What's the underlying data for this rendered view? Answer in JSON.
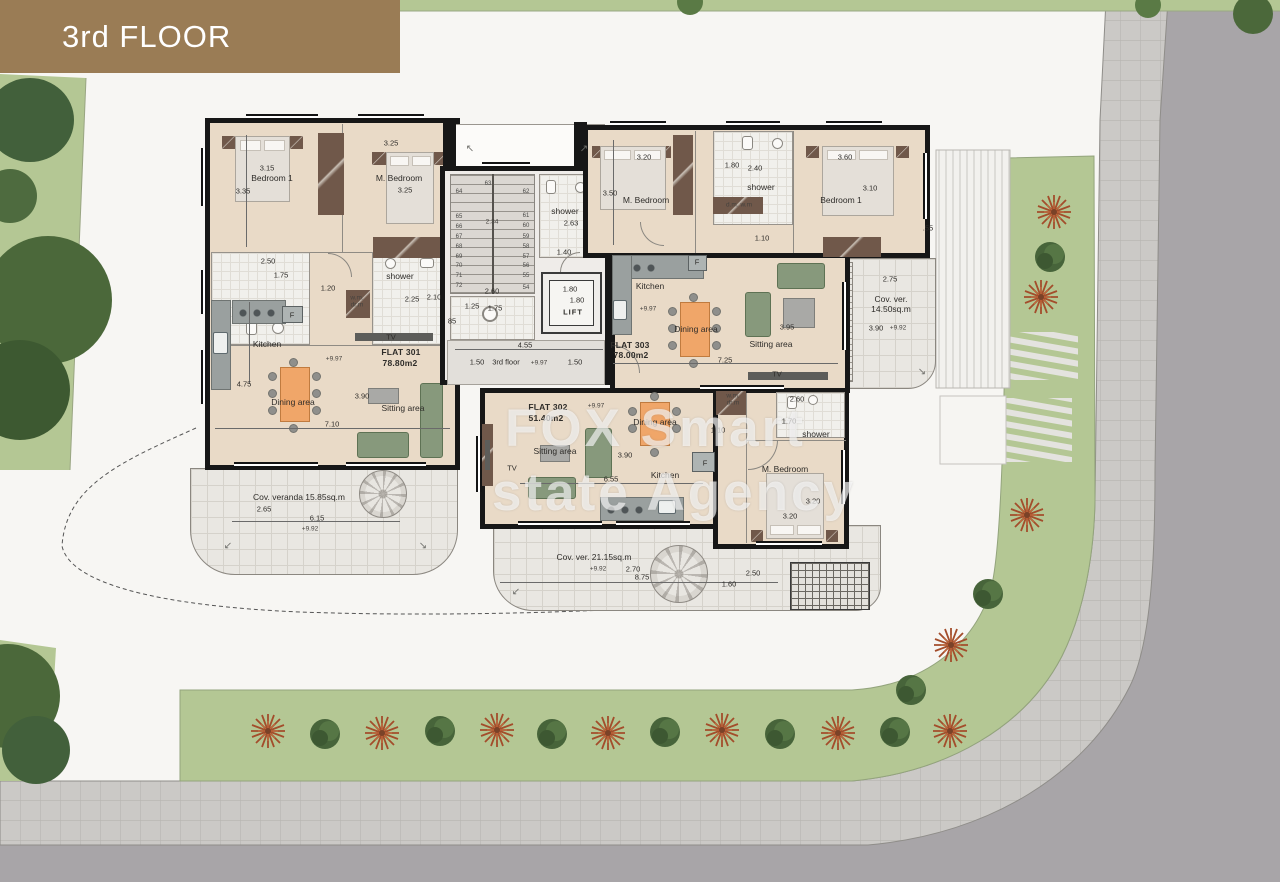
{
  "banner": {
    "title": "3rd FLOOR",
    "color": "#9a7c55"
  },
  "watermark": {
    "line1": "FOX Smart",
    "line2": "state Agency"
  },
  "flats": [
    {
      "id": "FLAT 301",
      "area": "78.80m2"
    },
    {
      "id": "FLAT 302",
      "area": "51.40m2"
    },
    {
      "id": "FLAT 303",
      "area": "78.00m2"
    }
  ],
  "core": {
    "lift": "LIFT",
    "floor_note": "1.50 3rd floor",
    "level": "+9.97"
  },
  "colors": {
    "banner": "#9a7c55",
    "floor": "#e9dac7",
    "wall": "#171717",
    "grass": "#b4c794",
    "road": "#a8a5a8",
    "sidewalk": "#cbc9c6",
    "sofa": "#87997c",
    "table": "#f0a669"
  },
  "labels": [
    {
      "t": "3.15",
      "x": 267,
      "y": 168,
      "c": "dim"
    },
    {
      "t": "Bedroom 1",
      "x": 272,
      "y": 178,
      "c": "room"
    },
    {
      "t": "3.35",
      "x": 243,
      "y": 191,
      "c": "dim"
    },
    {
      "t": "3.25",
      "x": 391,
      "y": 143,
      "c": "dim"
    },
    {
      "t": "M. Bedroom",
      "x": 399,
      "y": 178,
      "c": "room"
    },
    {
      "t": "3.25",
      "x": 405,
      "y": 190,
      "c": "dim"
    },
    {
      "t": "2.50",
      "x": 268,
      "y": 261,
      "c": "dim"
    },
    {
      "t": "1.75",
      "x": 281,
      "y": 275,
      "c": "dim"
    },
    {
      "t": "1.20",
      "x": 328,
      "y": 288,
      "c": "dim"
    },
    {
      "t": "shower",
      "x": 400,
      "y": 276,
      "c": "room"
    },
    {
      "t": "2.25",
      "x": 412,
      "y": 299,
      "c": "dim"
    },
    {
      "t": "2.10",
      "x": 434,
      "y": 297,
      "c": "dim"
    },
    {
      "t": "w.m.",
      "x": 357,
      "y": 298,
      "c": "tiny"
    },
    {
      "t": "dr.m",
      "x": 357,
      "y": 305,
      "c": "tiny"
    },
    {
      "t": "F",
      "x": 292,
      "y": 315,
      "c": "dim"
    },
    {
      "t": "Kitchen",
      "x": 267,
      "y": 344,
      "c": "room"
    },
    {
      "t": "TV",
      "x": 391,
      "y": 337,
      "c": "dim"
    },
    {
      "t": "FLAT 301",
      "x": 401,
      "y": 352,
      "c": "flat"
    },
    {
      "t": "78.80m2",
      "x": 400,
      "y": 363,
      "c": "flat"
    },
    {
      "t": "+9.97",
      "x": 334,
      "y": 359,
      "c": "tiny"
    },
    {
      "t": "4.75",
      "x": 244,
      "y": 384,
      "c": "dim"
    },
    {
      "t": "Dining area",
      "x": 293,
      "y": 402,
      "c": "room"
    },
    {
      "t": "3.90",
      "x": 362,
      "y": 396,
      "c": "dim"
    },
    {
      "t": "Sitting area",
      "x": 403,
      "y": 408,
      "c": "room"
    },
    {
      "t": "7.10",
      "x": 332,
      "y": 424,
      "c": "dim"
    },
    {
      "t": "Cov. veranda 15.85sq.m",
      "x": 299,
      "y": 497,
      "c": "room"
    },
    {
      "t": "2.65",
      "x": 264,
      "y": 509,
      "c": "dim"
    },
    {
      "t": "6.15",
      "x": 317,
      "y": 518,
      "c": "dim"
    },
    {
      "t": "+9.92",
      "x": 310,
      "y": 529,
      "c": "tiny"
    },
    {
      "t": "63",
      "x": 488,
      "y": 184,
      "c": "stair"
    },
    {
      "t": "64",
      "x": 459,
      "y": 192,
      "c": "stair"
    },
    {
      "t": "65",
      "x": 459,
      "y": 217,
      "c": "stair"
    },
    {
      "t": "66",
      "x": 459,
      "y": 227,
      "c": "stair"
    },
    {
      "t": "67",
      "x": 459,
      "y": 237,
      "c": "stair"
    },
    {
      "t": "68",
      "x": 459,
      "y": 247,
      "c": "stair"
    },
    {
      "t": "69",
      "x": 459,
      "y": 257,
      "c": "stair"
    },
    {
      "t": "70",
      "x": 459,
      "y": 266,
      "c": "stair"
    },
    {
      "t": "71",
      "x": 459,
      "y": 276,
      "c": "stair"
    },
    {
      "t": "72",
      "x": 459,
      "y": 286,
      "c": "stair"
    },
    {
      "t": "62",
      "x": 526,
      "y": 192,
      "c": "stair"
    },
    {
      "t": "61",
      "x": 526,
      "y": 216,
      "c": "stair"
    },
    {
      "t": "60",
      "x": 526,
      "y": 226,
      "c": "stair"
    },
    {
      "t": "59",
      "x": 526,
      "y": 237,
      "c": "stair"
    },
    {
      "t": "58",
      "x": 526,
      "y": 247,
      "c": "stair"
    },
    {
      "t": "57",
      "x": 526,
      "y": 257,
      "c": "stair"
    },
    {
      "t": "56",
      "x": 526,
      "y": 266,
      "c": "stair"
    },
    {
      "t": "55",
      "x": 526,
      "y": 276,
      "c": "stair"
    },
    {
      "t": "54",
      "x": 526,
      "y": 288,
      "c": "stair"
    },
    {
      "t": "2.34",
      "x": 492,
      "y": 222,
      "c": "tiny"
    },
    {
      "t": "shower",
      "x": 565,
      "y": 211,
      "c": "room"
    },
    {
      "t": "2.63",
      "x": 571,
      "y": 223,
      "c": "dim"
    },
    {
      "t": "1.40",
      "x": 564,
      "y": 252,
      "c": "dim"
    },
    {
      "t": "2.60",
      "x": 492,
      "y": 291,
      "c": "dim"
    },
    {
      "t": "1.25",
      "x": 472,
      "y": 306,
      "c": "dim"
    },
    {
      "t": "1.75",
      "x": 495,
      "y": 308,
      "c": "dim"
    },
    {
      "t": "85",
      "x": 452,
      "y": 321,
      "c": "dim"
    },
    {
      "t": "1.80",
      "x": 570,
      "y": 289,
      "c": "dim"
    },
    {
      "t": "1.80",
      "x": 577,
      "y": 300,
      "c": "dim"
    },
    {
      "t": "LIFT",
      "x": 573,
      "y": 312,
      "c": "lift"
    },
    {
      "t": "4.55",
      "x": 525,
      "y": 345,
      "c": "dim"
    },
    {
      "t": "1.50",
      "x": 477,
      "y": 362,
      "c": "dim"
    },
    {
      "t": "3rd floor",
      "x": 506,
      "y": 362,
      "c": "dim"
    },
    {
      "t": "+9.97",
      "x": 539,
      "y": 363,
      "c": "tiny"
    },
    {
      "t": "1.50",
      "x": 575,
      "y": 362,
      "c": "dim"
    },
    {
      "t": "3.20",
      "x": 644,
      "y": 157,
      "c": "dim"
    },
    {
      "t": "3.50",
      "x": 610,
      "y": 193,
      "c": "dim"
    },
    {
      "t": "M. Bedroom",
      "x": 646,
      "y": 200,
      "c": "room"
    },
    {
      "t": "1.80",
      "x": 732,
      "y": 165,
      "c": "dim"
    },
    {
      "t": "2.40",
      "x": 755,
      "y": 168,
      "c": "dim"
    },
    {
      "t": "shower",
      "x": 761,
      "y": 187,
      "c": "room"
    },
    {
      "t": "d.m. w.m",
      "x": 739,
      "y": 205,
      "c": "tiny"
    },
    {
      "t": "3.60",
      "x": 845,
      "y": 157,
      "c": "dim"
    },
    {
      "t": "3.10",
      "x": 870,
      "y": 188,
      "c": "dim"
    },
    {
      "t": "Bedroom 1",
      "x": 841,
      "y": 200,
      "c": "room"
    },
    {
      "t": "1.10",
      "x": 762,
      "y": 238,
      "c": "dim"
    },
    {
      "t": ".55",
      "x": 928,
      "y": 228,
      "c": "dim"
    },
    {
      "t": "F",
      "x": 697,
      "y": 262,
      "c": "dim"
    },
    {
      "t": "Kitchen",
      "x": 650,
      "y": 286,
      "c": "room"
    },
    {
      "t": "+9.97",
      "x": 648,
      "y": 309,
      "c": "tiny"
    },
    {
      "t": "Dining area",
      "x": 696,
      "y": 329,
      "c": "room"
    },
    {
      "t": "3.95",
      "x": 787,
      "y": 327,
      "c": "dim"
    },
    {
      "t": "Sitting area",
      "x": 771,
      "y": 344,
      "c": "room"
    },
    {
      "t": "FLAT 303",
      "x": 630,
      "y": 345,
      "c": "flat"
    },
    {
      "t": "78.00m2",
      "x": 631,
      "y": 355,
      "c": "flat"
    },
    {
      "t": "7.25",
      "x": 725,
      "y": 360,
      "c": "dim"
    },
    {
      "t": "TV",
      "x": 777,
      "y": 374,
      "c": "dim"
    },
    {
      "t": "2.75",
      "x": 890,
      "y": 279,
      "c": "dim"
    },
    {
      "t": "Cov. ver.",
      "x": 891,
      "y": 299,
      "c": "room"
    },
    {
      "t": "14.50sq.m",
      "x": 891,
      "y": 309,
      "c": "room"
    },
    {
      "t": "3.90",
      "x": 876,
      "y": 328,
      "c": "dim"
    },
    {
      "t": "+9.92",
      "x": 898,
      "y": 328,
      "c": "tiny"
    },
    {
      "t": "FLAT 302",
      "x": 548,
      "y": 407,
      "c": "flat"
    },
    {
      "t": "51.40m2",
      "x": 546,
      "y": 418,
      "c": "flat"
    },
    {
      "t": "+9.97",
      "x": 596,
      "y": 406,
      "c": "tiny"
    },
    {
      "t": "Dining area",
      "x": 655,
      "y": 422,
      "c": "room"
    },
    {
      "t": "1.10",
      "x": 718,
      "y": 430,
      "c": "dim"
    },
    {
      "t": "w.m.",
      "x": 733,
      "y": 396,
      "c": "tiny"
    },
    {
      "t": "dr.m",
      "x": 733,
      "y": 403,
      "c": "tiny"
    },
    {
      "t": "2.60",
      "x": 797,
      "y": 399,
      "c": "dim"
    },
    {
      "t": "1.70",
      "x": 789,
      "y": 421,
      "c": "dim"
    },
    {
      "t": "shower",
      "x": 816,
      "y": 434,
      "c": "room"
    },
    {
      "t": "Sitting area",
      "x": 555,
      "y": 451,
      "c": "room"
    },
    {
      "t": "3.90",
      "x": 625,
      "y": 455,
      "c": "dim"
    },
    {
      "t": "TV",
      "x": 512,
      "y": 468,
      "c": "dim"
    },
    {
      "t": "Kitchen",
      "x": 665,
      "y": 475,
      "c": "room"
    },
    {
      "t": "6.55",
      "x": 611,
      "y": 479,
      "c": "dim"
    },
    {
      "t": "F",
      "x": 705,
      "y": 463,
      "c": "dim"
    },
    {
      "t": "M. Bedroom",
      "x": 785,
      "y": 469,
      "c": "room"
    },
    {
      "t": "3.20",
      "x": 813,
      "y": 501,
      "c": "dim"
    },
    {
      "t": "3.20",
      "x": 790,
      "y": 516,
      "c": "dim"
    },
    {
      "t": "Cov. ver. 21.15sq.m",
      "x": 594,
      "y": 557,
      "c": "room"
    },
    {
      "t": "+9.92",
      "x": 598,
      "y": 569,
      "c": "tiny"
    },
    {
      "t": "2.70",
      "x": 633,
      "y": 569,
      "c": "dim"
    },
    {
      "t": "8.75",
      "x": 642,
      "y": 577,
      "c": "dim"
    },
    {
      "t": "2.50",
      "x": 753,
      "y": 573,
      "c": "dim"
    },
    {
      "t": "1.60",
      "x": 729,
      "y": 584,
      "c": "dim"
    },
    {
      "t": "↖",
      "x": 470,
      "y": 149,
      "c": "arrow"
    },
    {
      "t": "↗",
      "x": 584,
      "y": 149,
      "c": "arrow"
    },
    {
      "t": "↙",
      "x": 228,
      "y": 546,
      "c": "arrow"
    },
    {
      "t": "↘",
      "x": 423,
      "y": 546,
      "c": "arrow"
    },
    {
      "t": "↙",
      "x": 516,
      "y": 592,
      "c": "arrow"
    },
    {
      "t": "↘",
      "x": 922,
      "y": 372,
      "c": "arrow"
    }
  ]
}
